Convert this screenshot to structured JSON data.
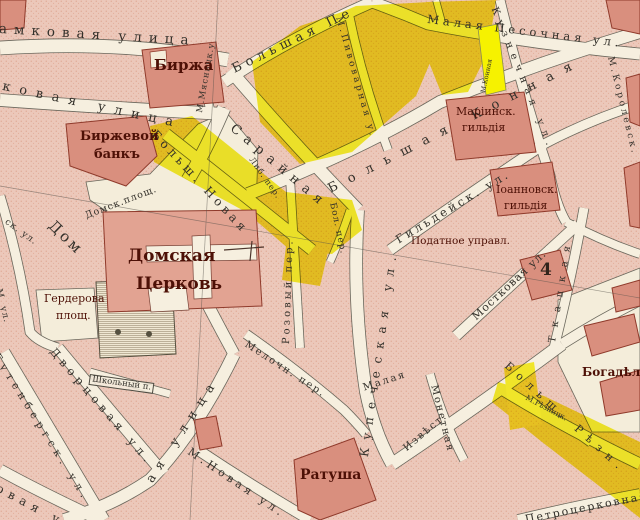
{
  "map": {
    "colors": {
      "paper": "#f5eedd",
      "block_pink": "#ecc8ba",
      "building_salmon": "#d98f7e",
      "building_outline": "#8f3a2b",
      "highlight_yellow": "#f2ec00",
      "street_outline": "#6a675c",
      "street_label": "#33302a",
      "place_label": "#4d1006"
    },
    "places": [
      {
        "text": "Биржа"
      },
      {
        "text": "Биржевой"
      },
      {
        "text": "банкъ"
      },
      {
        "text": "Домская"
      },
      {
        "text": "Церковь"
      },
      {
        "text": "Гердерова"
      },
      {
        "text": "площ."
      },
      {
        "text": "Ратуша"
      },
      {
        "text": "Маріинск."
      },
      {
        "text": "гильдія"
      },
      {
        "text": "Іоанновск."
      },
      {
        "text": "гильдія"
      },
      {
        "text": "Податное управл."
      },
      {
        "text": "Богадѣльня"
      },
      {
        "text": "4"
      }
    ],
    "streets": [
      {
        "text": "Замковая улица"
      },
      {
        "text": "М.Мясницк.у"
      },
      {
        "text": "ковая улица"
      },
      {
        "text": "Большая Пе"
      },
      {
        "text": "Малая Песочная ул."
      },
      {
        "text": "М.Пивоварная у."
      },
      {
        "text": "Кузнечная ул."
      },
      {
        "text": "М.Конная"
      },
      {
        "text": "Большая Конная"
      },
      {
        "text": "Сарайная"
      },
      {
        "text": "Больш. Новая"
      },
      {
        "text": "Либ. пер."
      },
      {
        "text": "Бол. пер."
      },
      {
        "text": "Гильдейск. ул."
      },
      {
        "text": "Купеческая ул."
      },
      {
        "text": "Розовый пер."
      },
      {
        "text": "Мелочн. пер."
      },
      {
        "text": "Мостковая ул."
      },
      {
        "text": "Ткацкая"
      },
      {
        "text": "Извѣст."
      },
      {
        "text": "Малая"
      },
      {
        "text": "Монетная"
      },
      {
        "text": "ая улица"
      },
      {
        "text": "М.Новая ул."
      },
      {
        "text": "Дворцовая ул."
      },
      {
        "text": "Гутенбергск. ул."
      },
      {
        "text": "Школьный п."
      },
      {
        "text": "Петроцерковная"
      },
      {
        "text": "Больш. Рѣзн."
      },
      {
        "text": "М.Рѣзницк."
      },
      {
        "text": "Домск.площ."
      },
      {
        "text": "Дом"
      },
      {
        "text": "ск. ул."
      },
      {
        "text": "М. ул."
      },
      {
        "text": "овая ул."
      },
      {
        "text": "М.Королевск."
      }
    ]
  }
}
